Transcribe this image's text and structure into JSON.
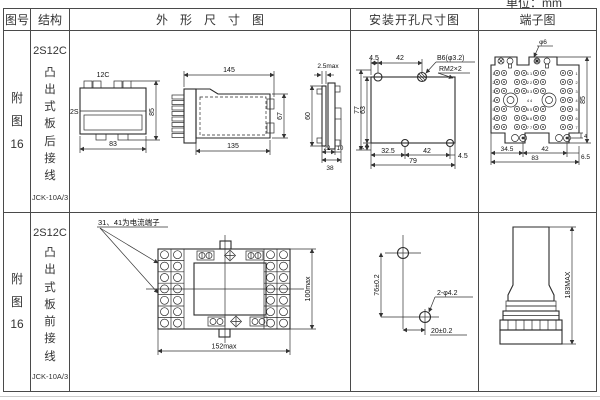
{
  "page": {
    "unit_label": "单位：mm"
  },
  "header": {
    "fig_no": "图号",
    "structure": "结构",
    "outline": "外形尺寸图",
    "mounting": "安装开孔尺寸图",
    "terminal": "端子图"
  },
  "rows": [
    {
      "fig_no": "附\n图\n16",
      "structure": {
        "model": "2S12C",
        "desc": "凸\n出\n式\n板\n后\n接\n线",
        "type": "JCK-10A/3"
      },
      "outline": {
        "top_view": {
          "label_top": "12C",
          "label_left": "2S",
          "width": "83",
          "height": "85"
        },
        "front_view": {
          "width_top": "145",
          "width_bottom": "135",
          "height": "67"
        },
        "side_view": {
          "thickness": "2.5max",
          "height": "60",
          "d1": "22",
          "d2": "10",
          "depth": "38"
        }
      },
      "mounting": {
        "t1": "4.5",
        "t2": "42",
        "hole_label": "B6(φ3.2)",
        "thread_label": "RM2×2",
        "l1": "77",
        "l2": "63",
        "b0": "7",
        "b1": "32.5",
        "b2": "42",
        "b3": "4.5",
        "total": "79"
      },
      "terminal": {
        "hole_label": "φ6",
        "rows": [
          "1",
          "2",
          "3",
          "4",
          "5",
          "6",
          "7"
        ],
        "mids": [
          "1 1",
          "2 2",
          "3 3",
          "4 4",
          "5 5",
          "6 6",
          "7 7"
        ],
        "b1": "34.5",
        "b2": "42",
        "b3": "6.5",
        "total": "83",
        "height": "85",
        "foot": "4"
      }
    },
    {
      "fig_no": "附\n图\n16",
      "structure": {
        "model": "2S12C",
        "desc": "凸\n出\n式\n板\n前\n接\n线",
        "type": "JCK-10A/3"
      },
      "outline": {
        "note": "31、41为电流端子",
        "height": "100max",
        "width": "152max"
      },
      "mounting": {
        "v": "76±0.2",
        "hole_label": "2-φ4.2",
        "h": "20±0.2"
      },
      "terminal": {
        "height": "183MAX"
      }
    }
  ]
}
